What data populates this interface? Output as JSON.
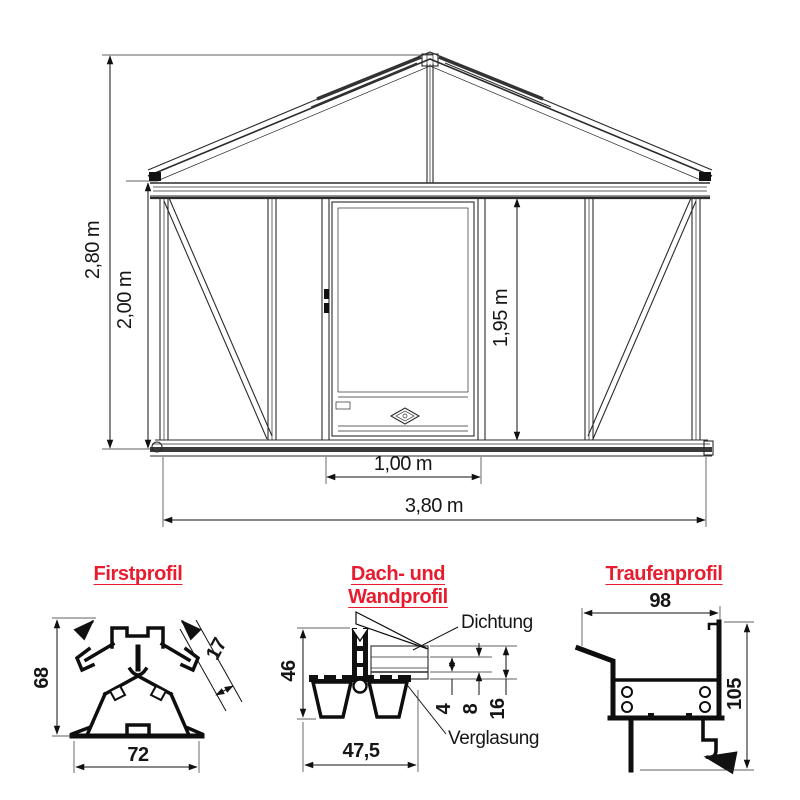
{
  "colors": {
    "accent_red": "#e81c2e",
    "ink": "#161616"
  },
  "elevation": {
    "dims": {
      "total_height": "2,80 m",
      "wall_height": "2,00 m",
      "door_height": "1,95 m",
      "door_width": "1,00 m",
      "total_width": "3,80 m"
    }
  },
  "profiles": {
    "first": {
      "title": "Firstprofil",
      "height_mm": "68",
      "glazing_mm": "17",
      "width_mm": "72"
    },
    "roof_wall": {
      "title": "Dach- und Wandprofil",
      "height_mm": "46",
      "seal_label": "Dichtung",
      "glazing_label": "Verglasung",
      "glass_mm": "4",
      "gap_mm": "8",
      "total_mm": "16",
      "width_mm": "47,5"
    },
    "eaves": {
      "title": "Traufenprofil",
      "width_mm": "98",
      "height_mm": "105"
    }
  }
}
